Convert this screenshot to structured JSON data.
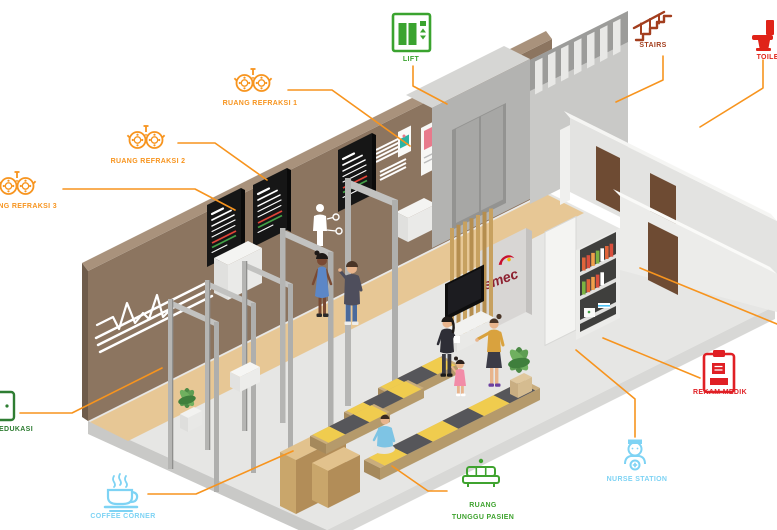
{
  "figure": {
    "type": "isometric-clinic-floorplan-infographic",
    "brand_logo": "smec"
  },
  "colors": {
    "callout_line": "#F7941E",
    "orange": "#F7941E",
    "green": "#3FA32F",
    "dark_green": "#2E7D32",
    "red": "#E02318",
    "rust": "#A33E1E",
    "light_blue": "#7ED3F4",
    "wall_brown": "#8C7560",
    "floor_gray": "#E6E6E4",
    "floor_tan": "#E7C795",
    "bench_yellow": "#F0CC4E",
    "logo_red": "#8E2231"
  },
  "callouts": {
    "refraksi1": {
      "label": "RUANG REFRAKSI 1",
      "icon": "trial-frame-icon"
    },
    "refraksi2": {
      "label": "RUANG REFRAKSI 2",
      "icon": "trial-frame-icon"
    },
    "refraksi3": {
      "label": "RUANG REFRAKSI 3",
      "icon": "trial-frame-icon"
    },
    "lift": {
      "label": "LIFT",
      "icon": "elevator-icon"
    },
    "stairs": {
      "label": "STAIRS",
      "icon": "stairs-icon"
    },
    "toilet": {
      "label": "TOILET",
      "icon": "toilet-icon"
    },
    "rekam_medik": {
      "label": "REKAM MEDIK",
      "icon": "medical-record-icon"
    },
    "nurse_station": {
      "label": "NURSE STATION",
      "icon": "nurse-icon"
    },
    "coffee_corner": {
      "label": "COFFEE CORNER",
      "icon": "coffee-cup-icon"
    },
    "ruang_tunggu_pasien": {
      "label_line1": "RUANG",
      "label_line2": "TUNGGU PASIEN",
      "icon": "sofa-icon"
    },
    "edukasi": {
      "label": "EDUKASI",
      "icon": "book-icon"
    }
  },
  "scene": {
    "logo_text": "smec"
  }
}
